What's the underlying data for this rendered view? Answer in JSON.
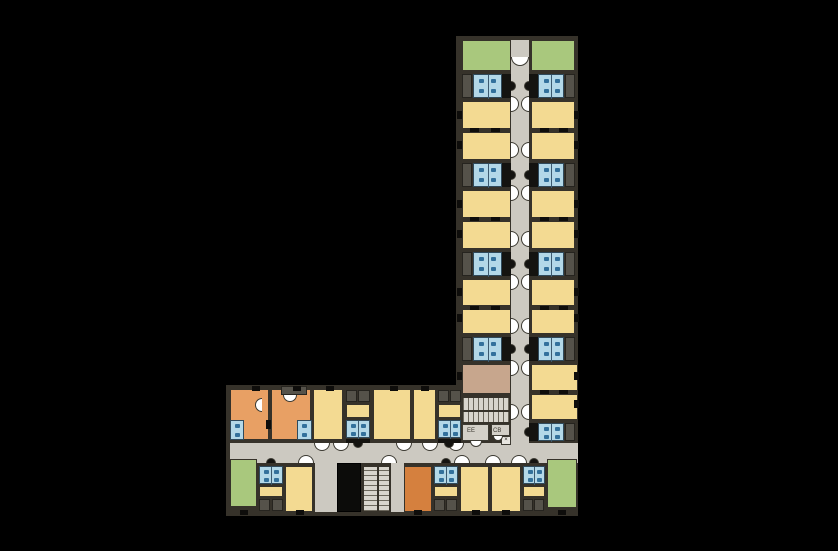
{
  "palette": {
    "background": "#000000",
    "wall": "#36322a",
    "corridor": "#ccc9c1",
    "yellow": "#f3da92",
    "green": "#a9c87d",
    "orange": "#e8a064",
    "orange_dark": "#d5803e",
    "brown": "#c7a68d",
    "pod_blue": "#b3d8e8",
    "fixture_blue": "#33719c",
    "closet_gray": "#55524a",
    "stair_gray": "#d8d5cd",
    "shaft_black": "#141310"
  },
  "labels": [
    {
      "text": "EE",
      "x": 467,
      "y": 428
    },
    {
      "text": "CB",
      "x": 493,
      "y": 428
    }
  ],
  "x_box": {
    "text": "×",
    "x": 501,
    "y": 436,
    "w": 10,
    "h": 9
  },
  "slabs": [
    [
      456,
      36,
      122,
      412
    ],
    [
      226,
      385,
      352,
      131
    ]
  ],
  "corridors": [
    [
      511,
      40,
      18,
      406
    ],
    [
      230,
      443,
      348,
      20
    ],
    [
      315,
      463,
      22,
      49
    ],
    [
      391,
      463,
      13,
      49
    ]
  ],
  "rooms": [
    {
      "t": "green",
      "x": 462,
      "y": 40,
      "w": 49,
      "h": 31
    },
    {
      "t": "green",
      "x": 531,
      "y": 40,
      "w": 44,
      "h": 31
    },
    {
      "t": "yellow",
      "x": 462,
      "y": 101,
      "w": 49,
      "h": 28
    },
    {
      "t": "yellow",
      "x": 462,
      "y": 132,
      "w": 49,
      "h": 28
    },
    {
      "t": "yellow",
      "x": 531,
      "y": 101,
      "w": 44,
      "h": 28
    },
    {
      "t": "yellow",
      "x": 531,
      "y": 132,
      "w": 44,
      "h": 28
    },
    {
      "t": "yellow",
      "x": 462,
      "y": 190,
      "w": 49,
      "h": 28
    },
    {
      "t": "yellow",
      "x": 462,
      "y": 221,
      "w": 49,
      "h": 28
    },
    {
      "t": "yellow",
      "x": 531,
      "y": 190,
      "w": 44,
      "h": 28
    },
    {
      "t": "yellow",
      "x": 531,
      "y": 221,
      "w": 44,
      "h": 28
    },
    {
      "t": "yellow",
      "x": 462,
      "y": 279,
      "w": 49,
      "h": 27
    },
    {
      "t": "yellow",
      "x": 462,
      "y": 309,
      "w": 49,
      "h": 25
    },
    {
      "t": "yellow",
      "x": 531,
      "y": 279,
      "w": 44,
      "h": 27
    },
    {
      "t": "yellow",
      "x": 531,
      "y": 309,
      "w": 44,
      "h": 25
    },
    {
      "t": "brown",
      "x": 462,
      "y": 364,
      "w": 49,
      "h": 30
    },
    {
      "t": "yellow",
      "x": 531,
      "y": 364,
      "w": 47,
      "h": 27
    },
    {
      "t": "yellow",
      "x": 531,
      "y": 394,
      "w": 47,
      "h": 26
    },
    {
      "t": "orange",
      "x": 230,
      "y": 389,
      "w": 39,
      "h": 51
    },
    {
      "t": "orange",
      "x": 271,
      "y": 389,
      "w": 40,
      "h": 51
    },
    {
      "t": "yellow",
      "x": 313,
      "y": 389,
      "w": 30,
      "h": 51
    },
    {
      "t": "yellow",
      "x": 373,
      "y": 389,
      "w": 38,
      "h": 51
    },
    {
      "t": "yellow",
      "x": 413,
      "y": 389,
      "w": 23,
      "h": 51
    },
    {
      "t": "green",
      "x": 230,
      "y": 459,
      "w": 27,
      "h": 48
    },
    {
      "t": "yellow",
      "x": 285,
      "y": 466,
      "w": 28,
      "h": 46
    },
    {
      "t": "orange_dark",
      "x": 404,
      "y": 466,
      "w": 28,
      "h": 46
    },
    {
      "t": "yellow",
      "x": 460,
      "y": 466,
      "w": 29,
      "h": 46
    },
    {
      "t": "yellow",
      "x": 491,
      "y": 466,
      "w": 30,
      "h": 46
    },
    {
      "t": "green",
      "x": 547,
      "y": 459,
      "w": 30,
      "h": 49
    },
    {
      "t": "yellow",
      "x": 346,
      "y": 404,
      "w": 24,
      "h": 14
    },
    {
      "t": "yellow",
      "x": 438,
      "y": 404,
      "w": 23,
      "h": 14
    },
    {
      "t": "yellow",
      "x": 259,
      "y": 486,
      "w": 24,
      "h": 11
    },
    {
      "t": "yellow",
      "x": 434,
      "y": 486,
      "w": 24,
      "h": 11
    },
    {
      "t": "yellow",
      "x": 523,
      "y": 486,
      "w": 22,
      "h": 11
    }
  ],
  "pods": [
    [
      473,
      74,
      29,
      24
    ],
    [
      538,
      74,
      26,
      24
    ],
    [
      473,
      163,
      29,
      24
    ],
    [
      538,
      163,
      26,
      24
    ],
    [
      473,
      252,
      29,
      24
    ],
    [
      538,
      252,
      26,
      24
    ],
    [
      473,
      337,
      29,
      24
    ],
    [
      538,
      337,
      26,
      24
    ],
    [
      538,
      423,
      26,
      18
    ],
    [
      346,
      420,
      24,
      18
    ],
    [
      438,
      420,
      23,
      18
    ],
    [
      230,
      420,
      14,
      20
    ],
    [
      297,
      420,
      15,
      20
    ],
    [
      259,
      466,
      24,
      18
    ],
    [
      434,
      466,
      24,
      18
    ],
    [
      523,
      466,
      22,
      18
    ]
  ],
  "closets": [
    [
      462,
      74,
      10,
      24
    ],
    [
      565,
      74,
      10,
      24
    ],
    [
      462,
      163,
      10,
      24
    ],
    [
      565,
      163,
      10,
      24
    ],
    [
      462,
      252,
      10,
      24
    ],
    [
      565,
      252,
      10,
      24
    ],
    [
      462,
      337,
      10,
      24
    ],
    [
      565,
      337,
      10,
      24
    ],
    [
      565,
      423,
      10,
      18
    ],
    [
      346,
      390,
      11,
      12
    ],
    [
      358,
      390,
      12,
      12
    ],
    [
      438,
      390,
      11,
      12
    ],
    [
      450,
      390,
      11,
      12
    ],
    [
      281,
      386,
      26,
      9
    ],
    [
      259,
      499,
      11,
      12
    ],
    [
      272,
      499,
      11,
      12
    ],
    [
      434,
      499,
      11,
      12
    ],
    [
      446,
      499,
      11,
      12
    ],
    [
      523,
      499,
      10,
      12
    ],
    [
      534,
      499,
      10,
      12
    ]
  ],
  "shafts": [
    [
      502,
      74,
      9,
      24
    ],
    [
      529,
      74,
      9,
      24
    ],
    [
      502,
      163,
      9,
      24
    ],
    [
      529,
      163,
      9,
      24
    ],
    [
      502,
      252,
      9,
      24
    ],
    [
      529,
      252,
      9,
      24
    ],
    [
      502,
      337,
      9,
      24
    ],
    [
      529,
      337,
      9,
      24
    ],
    [
      529,
      423,
      9,
      18
    ],
    [
      346,
      439,
      24,
      4
    ],
    [
      438,
      439,
      23,
      4
    ]
  ],
  "elevator": [
    337,
    463,
    24,
    49
  ],
  "stairs": [
    {
      "x": 462,
      "y": 397,
      "w": 48,
      "h": 26,
      "dir": "h"
    },
    {
      "x": 363,
      "y": 466,
      "w": 27,
      "h": 46,
      "dir": "v"
    }
  ],
  "utilities": [
    {
      "x": 462,
      "y": 424,
      "w": 27,
      "h": 17
    },
    {
      "x": 491,
      "y": 424,
      "w": 19,
      "h": 12
    }
  ],
  "arcs": [
    {
      "x": 520,
      "y": 57,
      "dir": "down",
      "r": 9,
      "k": "white"
    },
    {
      "x": 511,
      "y": 104,
      "dir": "right",
      "r": 8,
      "k": "white"
    },
    {
      "x": 529,
      "y": 104,
      "dir": "left",
      "r": 8,
      "k": "white"
    },
    {
      "x": 511,
      "y": 150,
      "dir": "right",
      "r": 8,
      "k": "white"
    },
    {
      "x": 529,
      "y": 150,
      "dir": "left",
      "r": 8,
      "k": "white"
    },
    {
      "x": 511,
      "y": 193,
      "dir": "right",
      "r": 8,
      "k": "white"
    },
    {
      "x": 529,
      "y": 193,
      "dir": "left",
      "r": 8,
      "k": "white"
    },
    {
      "x": 511,
      "y": 239,
      "dir": "right",
      "r": 8,
      "k": "white"
    },
    {
      "x": 529,
      "y": 239,
      "dir": "left",
      "r": 8,
      "k": "white"
    },
    {
      "x": 511,
      "y": 282,
      "dir": "right",
      "r": 8,
      "k": "white"
    },
    {
      "x": 529,
      "y": 282,
      "dir": "left",
      "r": 8,
      "k": "white"
    },
    {
      "x": 511,
      "y": 326,
      "dir": "right",
      "r": 8,
      "k": "white"
    },
    {
      "x": 529,
      "y": 326,
      "dir": "left",
      "r": 8,
      "k": "white"
    },
    {
      "x": 511,
      "y": 368,
      "dir": "right",
      "r": 8,
      "k": "white"
    },
    {
      "x": 529,
      "y": 368,
      "dir": "left",
      "r": 8,
      "k": "white"
    },
    {
      "x": 511,
      "y": 412,
      "dir": "right",
      "r": 8,
      "k": "white"
    },
    {
      "x": 529,
      "y": 412,
      "dir": "left",
      "r": 8,
      "k": "white"
    },
    {
      "x": 322,
      "y": 443,
      "dir": "down",
      "r": 8,
      "k": "white"
    },
    {
      "x": 341,
      "y": 443,
      "dir": "down",
      "r": 8,
      "k": "white"
    },
    {
      "x": 404,
      "y": 443,
      "dir": "down",
      "r": 8,
      "k": "white"
    },
    {
      "x": 430,
      "y": 443,
      "dir": "down",
      "r": 8,
      "k": "white"
    },
    {
      "x": 456,
      "y": 443,
      "dir": "down",
      "r": 8,
      "k": "white"
    },
    {
      "x": 306,
      "y": 463,
      "dir": "up",
      "r": 8,
      "k": "white"
    },
    {
      "x": 389,
      "y": 463,
      "dir": "up",
      "r": 8,
      "k": "white"
    },
    {
      "x": 462,
      "y": 463,
      "dir": "up",
      "r": 8,
      "k": "white"
    },
    {
      "x": 493,
      "y": 463,
      "dir": "up",
      "r": 8,
      "k": "white"
    },
    {
      "x": 519,
      "y": 463,
      "dir": "up",
      "r": 8,
      "k": "white"
    },
    {
      "x": 262,
      "y": 405,
      "dir": "left",
      "r": 7,
      "k": "white"
    },
    {
      "x": 290,
      "y": 395,
      "dir": "down",
      "r": 7,
      "k": "white"
    },
    {
      "x": 476,
      "y": 441,
      "dir": "down",
      "r": 6,
      "k": "white"
    },
    {
      "x": 498,
      "y": 436,
      "dir": "down",
      "r": 5,
      "k": "white"
    },
    {
      "x": 511,
      "y": 86,
      "dir": "right",
      "r": 5,
      "k": "black"
    },
    {
      "x": 529,
      "y": 86,
      "dir": "left",
      "r": 5,
      "k": "black"
    },
    {
      "x": 511,
      "y": 175,
      "dir": "right",
      "r": 5,
      "k": "black"
    },
    {
      "x": 529,
      "y": 175,
      "dir": "left",
      "r": 5,
      "k": "black"
    },
    {
      "x": 511,
      "y": 264,
      "dir": "right",
      "r": 5,
      "k": "black"
    },
    {
      "x": 529,
      "y": 264,
      "dir": "left",
      "r": 5,
      "k": "black"
    },
    {
      "x": 511,
      "y": 349,
      "dir": "right",
      "r": 5,
      "k": "black"
    },
    {
      "x": 529,
      "y": 349,
      "dir": "left",
      "r": 5,
      "k": "black"
    },
    {
      "x": 529,
      "y": 432,
      "dir": "left",
      "r": 5,
      "k": "black"
    },
    {
      "x": 358,
      "y": 443,
      "dir": "down",
      "r": 5,
      "k": "black"
    },
    {
      "x": 449,
      "y": 443,
      "dir": "down",
      "r": 5,
      "k": "black"
    },
    {
      "x": 271,
      "y": 463,
      "dir": "up",
      "r": 5,
      "k": "black"
    },
    {
      "x": 446,
      "y": 463,
      "dir": "up",
      "r": 5,
      "k": "black"
    },
    {
      "x": 534,
      "y": 463,
      "dir": "up",
      "r": 5,
      "k": "black"
    }
  ],
  "marks": [
    [
      470,
      128,
      9,
      4
    ],
    [
      491,
      128,
      9,
      4
    ],
    [
      540,
      128,
      9,
      4
    ],
    [
      559,
      128,
      9,
      4
    ],
    [
      470,
      217,
      9,
      4
    ],
    [
      491,
      217,
      9,
      4
    ],
    [
      540,
      217,
      9,
      4
    ],
    [
      559,
      217,
      9,
      4
    ],
    [
      470,
      306,
      9,
      4
    ],
    [
      491,
      306,
      9,
      4
    ],
    [
      540,
      306,
      9,
      4
    ],
    [
      559,
      306,
      9,
      4
    ],
    [
      540,
      390,
      9,
      4
    ],
    [
      559,
      390,
      9,
      4
    ],
    [
      457,
      111,
      5,
      8
    ],
    [
      457,
      141,
      5,
      8
    ],
    [
      457,
      200,
      5,
      8
    ],
    [
      457,
      230,
      5,
      8
    ],
    [
      457,
      288,
      5,
      8
    ],
    [
      457,
      314,
      5,
      8
    ],
    [
      457,
      372,
      5,
      8
    ],
    [
      574,
      111,
      5,
      8
    ],
    [
      574,
      141,
      5,
      8
    ],
    [
      574,
      200,
      5,
      8
    ],
    [
      574,
      230,
      5,
      8
    ],
    [
      574,
      288,
      5,
      8
    ],
    [
      574,
      314,
      5,
      8
    ],
    [
      574,
      372,
      5,
      8
    ],
    [
      574,
      400,
      5,
      8
    ],
    [
      252,
      386,
      8,
      5
    ],
    [
      293,
      386,
      8,
      5
    ],
    [
      326,
      386,
      8,
      5
    ],
    [
      390,
      386,
      8,
      5
    ],
    [
      421,
      386,
      8,
      5
    ],
    [
      240,
      510,
      8,
      5
    ],
    [
      296,
      510,
      8,
      5
    ],
    [
      414,
      510,
      8,
      5
    ],
    [
      472,
      510,
      8,
      5
    ],
    [
      502,
      510,
      8,
      5
    ],
    [
      558,
      510,
      8,
      5
    ],
    [
      266,
      420,
      5,
      9
    ]
  ]
}
